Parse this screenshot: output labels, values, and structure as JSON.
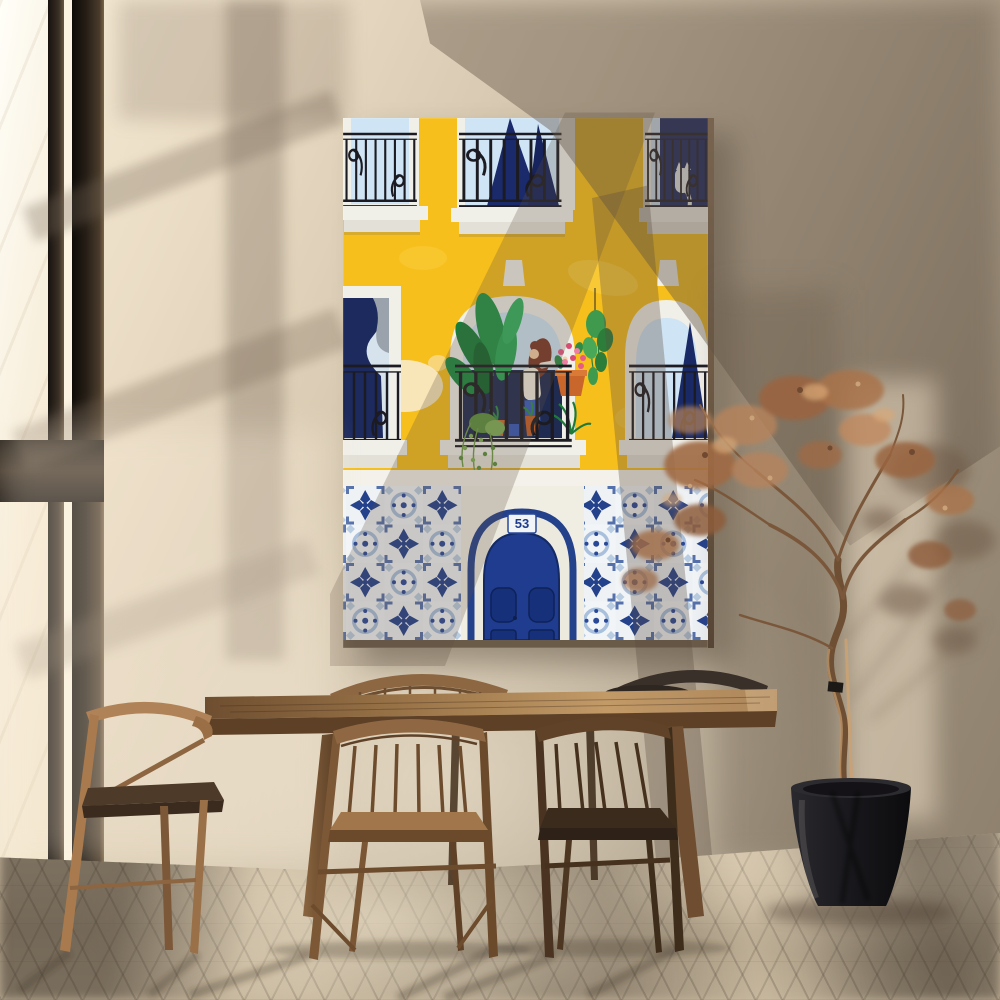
{
  "scene": {
    "setting": "sunlit dining room interior with strong window shadows",
    "art_print_subject": "yellow Lisbon-style building facade with wrought-iron balconies, window plants, a white cat, azulejo tiles and an arched blue door",
    "objects": [
      "canvas wall art",
      "floor-to-ceiling window",
      "wooden dining table",
      "spindle-back dining chairs",
      "dried tree in black planter",
      "herringbone parquet floor"
    ]
  },
  "poster": {
    "door_number": "53"
  },
  "palette": {
    "wall_light": "#f6ecd7",
    "wall_dark": "#8b7e6b",
    "poster_yellow": "#f6bf1c",
    "poster_white": "#f0efe8",
    "tile_navy": "#24418c",
    "tile_light": "#a9c0dd",
    "door_navy": "#1f3c8e",
    "glass_blue": "#cfe4f4",
    "curtain_navy": "#17255f",
    "railing_black": "#1c1b22",
    "plant_green": "#219347",
    "flower_pink": "#e85b85",
    "terracotta": "#c9662b",
    "cat_white": "#e9ecee",
    "wood_light": "#c29a68",
    "wood_dark": "#553a22",
    "floor_light": "#d5c6ac",
    "tree_rust": "#a06a43",
    "pot_black": "#141316"
  }
}
